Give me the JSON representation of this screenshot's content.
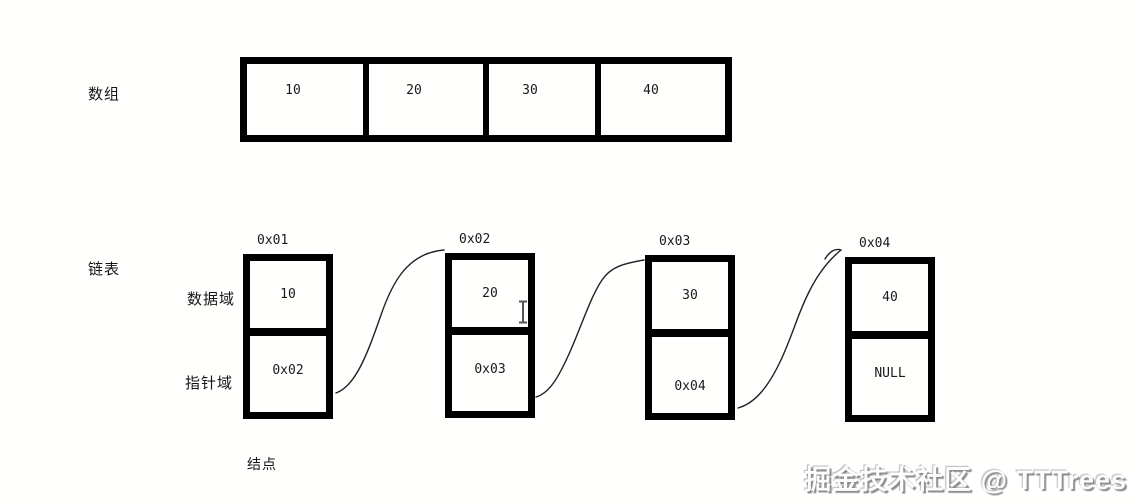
{
  "page": {
    "background": "#ffffff"
  },
  "array_section": {
    "label": "数组",
    "cells": [
      "10",
      "20",
      "30",
      "40"
    ]
  },
  "list_section": {
    "label": "链表",
    "data_field_label": "数据域",
    "pointer_field_label": "指针域",
    "node_caption": "结点",
    "nodes": [
      {
        "address": "0x01",
        "data": "10",
        "pointer": "0x02"
      },
      {
        "address": "0x02",
        "data": "20",
        "pointer": "0x03"
      },
      {
        "address": "0x03",
        "data": "30",
        "pointer": "0x04"
      },
      {
        "address": "0x04",
        "data": "40",
        "pointer": "NULL"
      }
    ]
  },
  "cursor": {
    "type": "text-ibeam"
  },
  "watermark": {
    "text": "掘金技术社区 @ TTTrees"
  },
  "colors": {
    "line": "#000000",
    "watermark_shadow": "#8c8c8c"
  }
}
